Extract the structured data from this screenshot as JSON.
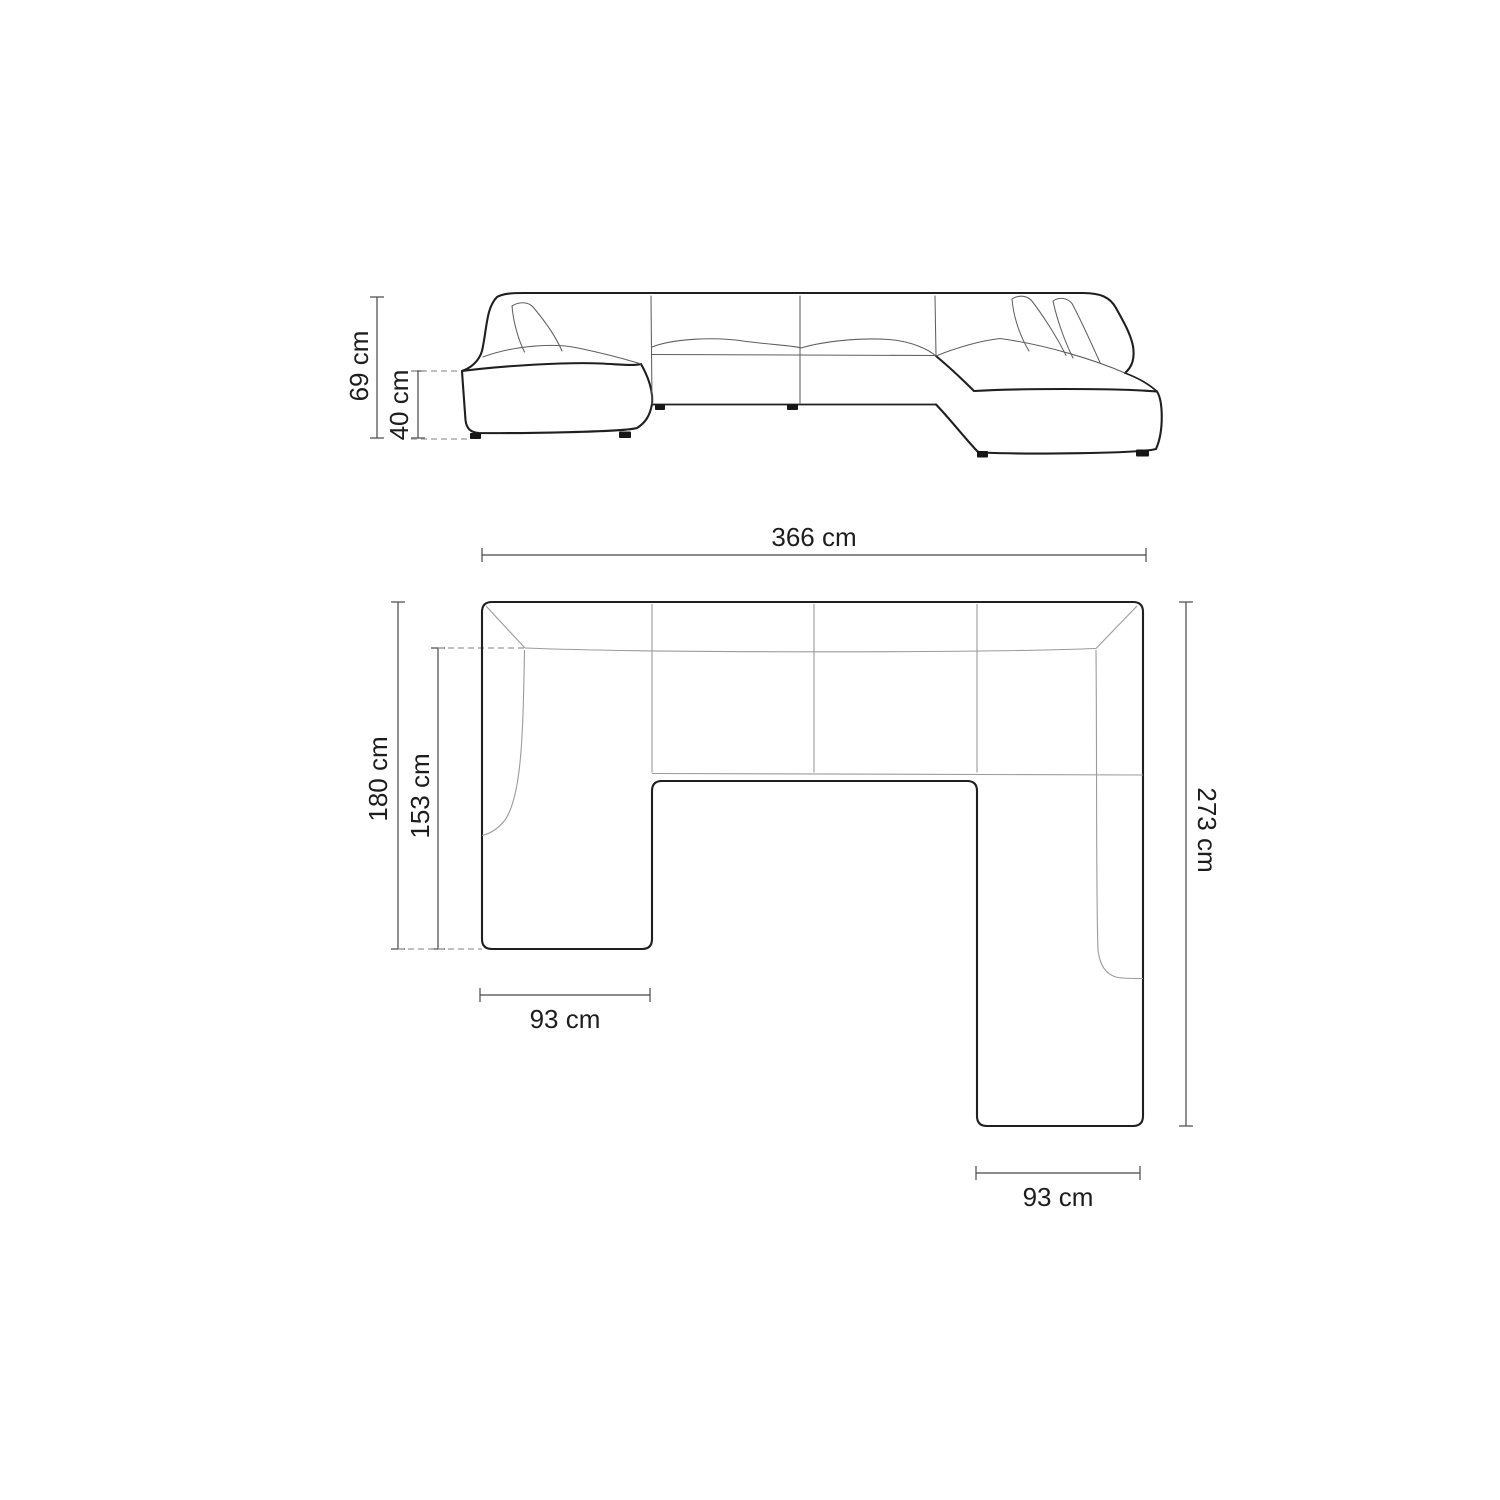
{
  "diagram": {
    "type": "furniture-dimension-drawing",
    "subject": "U-shaped panoramic sofa, front elevation and top plan views",
    "front": {
      "total_height": "69 cm",
      "seat_height": "40 cm"
    },
    "plan": {
      "total_width": "366 cm",
      "left_depth": "180 cm",
      "left_inner_depth": "153 cm",
      "right_depth": "273 cm",
      "left_chaise_width": "93 cm",
      "right_chaise_width": "93 cm"
    },
    "colors": {
      "outline": "#1f1f1f",
      "interior_line_elevation": "#5f5f5f",
      "interior_line_plan": "#9b9b9b",
      "dimension_line": "#474747",
      "text": "#1d1d1d",
      "background": "#ffffff"
    }
  }
}
